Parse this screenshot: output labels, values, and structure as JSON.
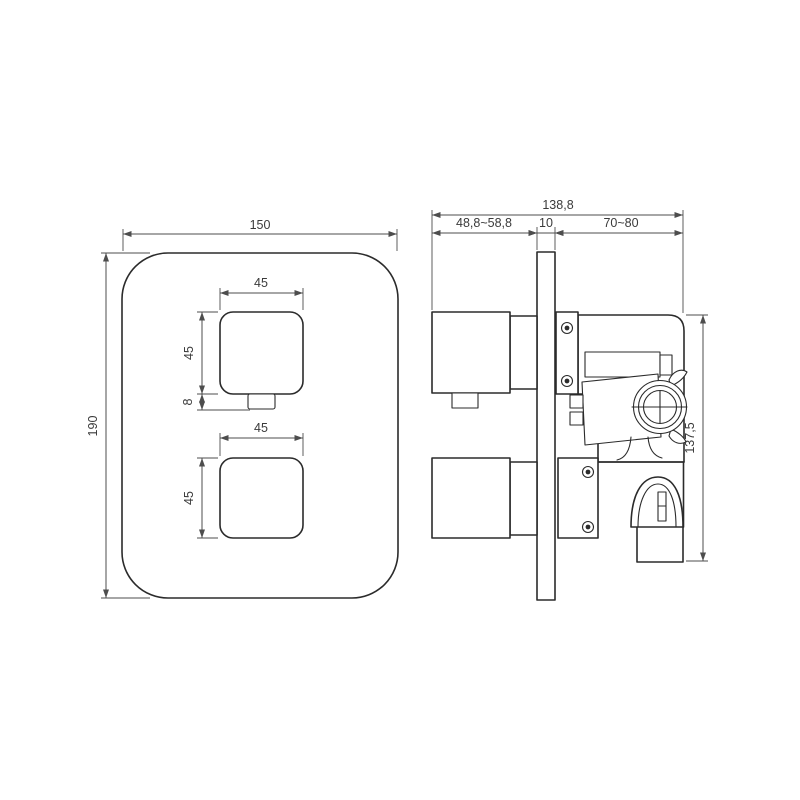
{
  "colors": {
    "background": "#ffffff",
    "object_line": "#2b2b2b",
    "dimension_line": "#4d4d4d",
    "dimension_text": "#3a3a3a"
  },
  "front_view": {
    "plate_width": "150",
    "plate_height": "190",
    "top_handle_width": "45",
    "top_handle_height": "45",
    "handle_nub_height": "8",
    "bottom_handle_width": "45",
    "bottom_handle_height": "45"
  },
  "side_view": {
    "overall_depth": "138,8",
    "recessed_depth_range": "48,8~58,8",
    "wall_plate_thickness": "10",
    "protruding_depth_range": "70~80",
    "valve_body_height": "137,5"
  }
}
